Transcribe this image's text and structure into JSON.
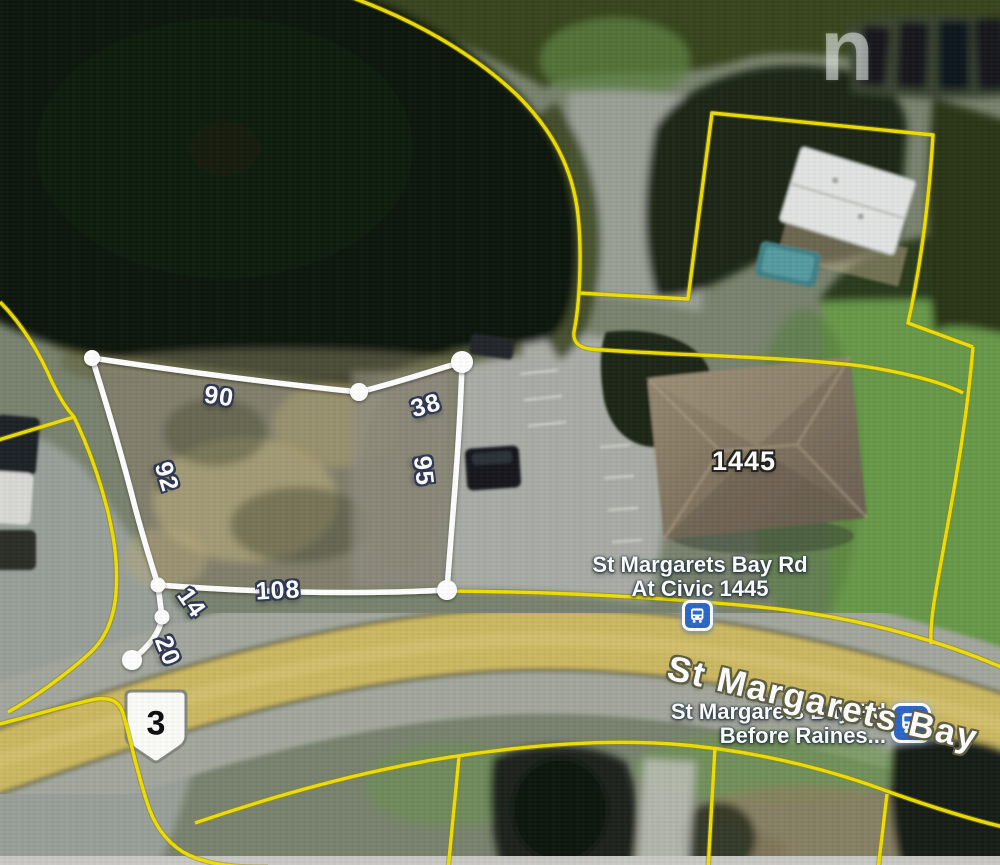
{
  "map": {
    "parcel": {
      "measurements": {
        "top": "90",
        "top_right": "38",
        "left": "92",
        "right": "95",
        "bottom": "108",
        "tail_upper": "14",
        "tail_lower": "20"
      }
    },
    "labels": {
      "civic_number": "1445",
      "road_name": "St Margarets Bay",
      "route_number": "3",
      "watermark": "n"
    },
    "bus_stops": [
      {
        "line1": "St Margarets Bay Rd",
        "line2": "At Civic 1445"
      },
      {
        "line1": "St Margarets Bay Rd",
        "line2": "Before Raines..."
      }
    ],
    "colors": {
      "boundary_line": "#f2e104",
      "parcel_outline": "#ffffff",
      "bus_icon_blue": "#2b66c8",
      "road_fill": "#cdb962"
    }
  }
}
